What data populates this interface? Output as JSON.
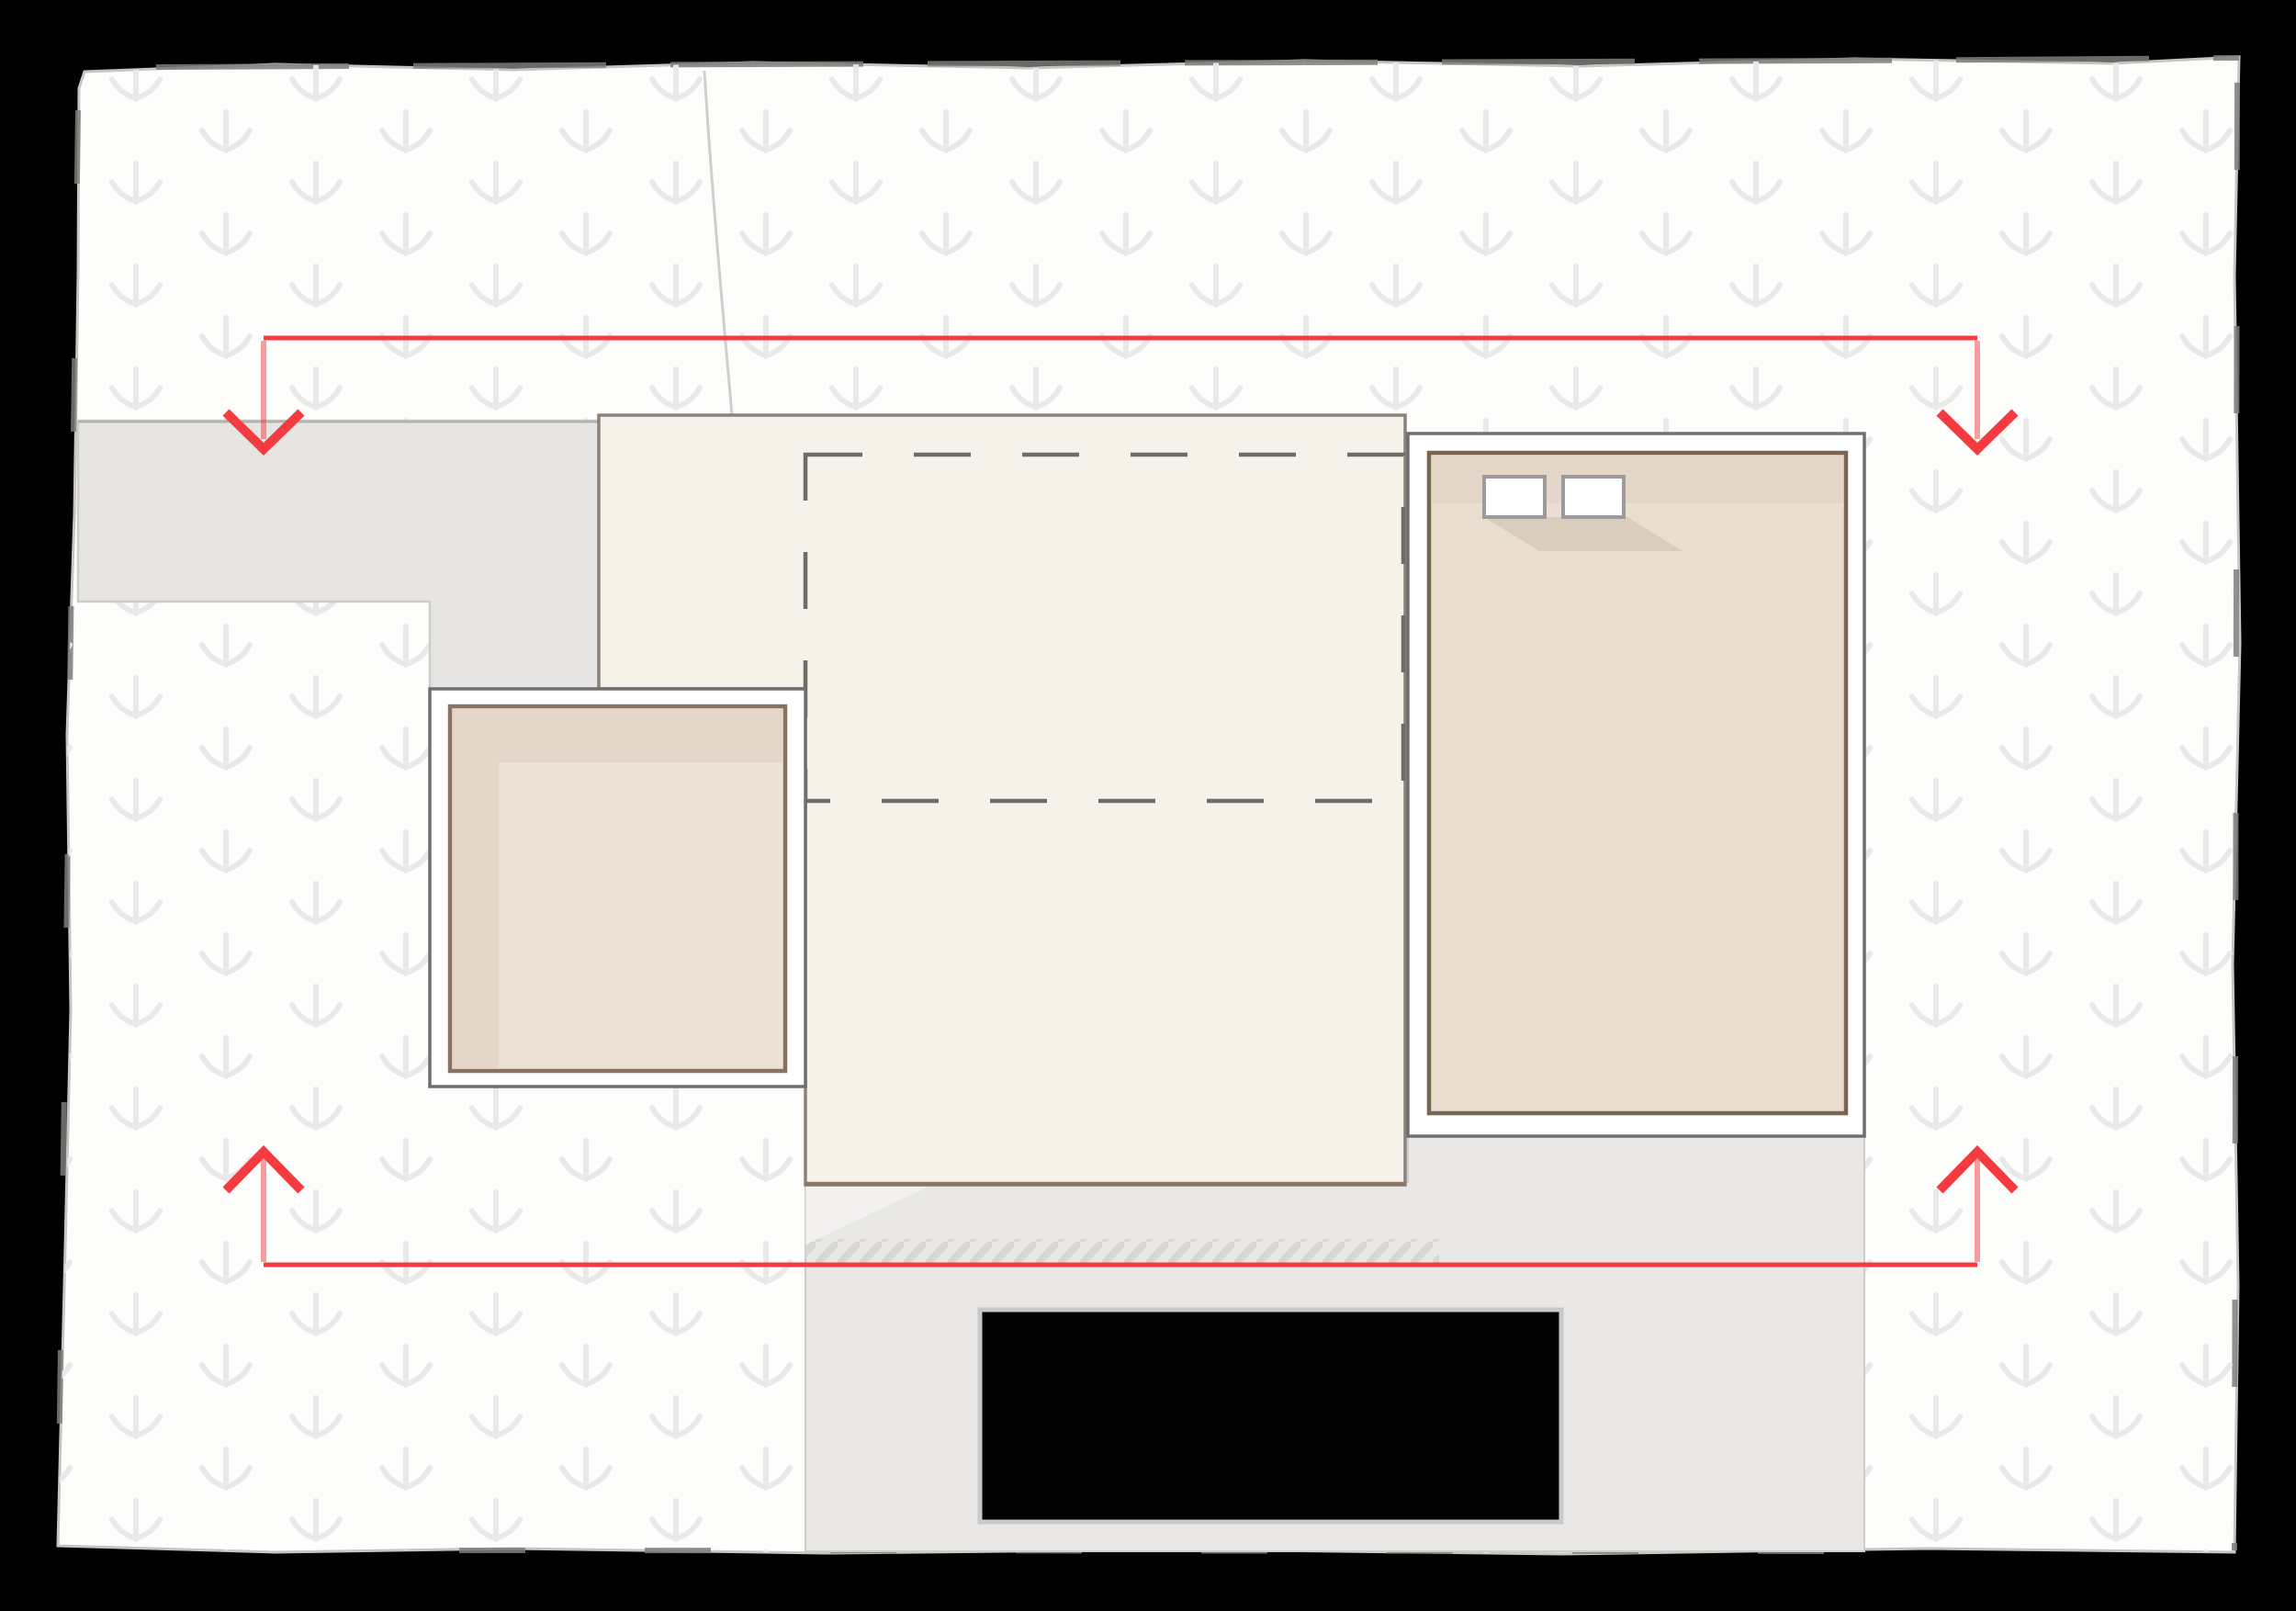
{
  "document": {
    "kind": "architectural-site-plan-sketch",
    "visible_text": [],
    "description": "Hand-drawn style site plan: white parcel sheet on black background, faint planting-arrow pattern, gray road and driveway, cream main building with dashed roof outline, two tan accessory volumes in white frames, two roof skylights, red dimension arrows across top and bottom, hatched crossing strip on driveway, solid black vehicle rectangle."
  },
  "legend": {
    "pattern_symbol": "down-arrow-planting-icon",
    "dimension_marks": "red arrows pointing into parcel at four corners",
    "boundary_style": "sketchy gray outline with intermittent darker dashes"
  },
  "counts": {
    "buildings": 3,
    "skylights": 2,
    "red_arrows": 4,
    "vehicles_or_labels": 1
  },
  "colors": {
    "accent_red": "#f43b3f",
    "paper": "#fdfdfc",
    "paper_edge": "#c6c5c2",
    "paper_edge_dark": "#7d7c7a",
    "crease": "#cfcfcd",
    "pattern_glyph": "#e9e9e9",
    "road": "#e6e5e3",
    "driveway": "#e9e8e6",
    "road_edge_dark": "#b3b2af",
    "road_edge_light": "#cecdca",
    "building_fill": "#f6f1e9",
    "building_border": "#8b8278",
    "building_bottom_border": "#877763",
    "frame_fill": "#ffffff",
    "frame_border": "#6f6f6f",
    "tan_left": "#ece2d6",
    "tan_right": "#e9decf",
    "tan_dark_strip": "#e4d7c9",
    "tan_shadow": "#c9bcae",
    "tan_border_left": "#8a7260",
    "tan_border_right": "#7b6452",
    "skylight_fill": "#ffffff",
    "skylight_border": "#9b9b9b",
    "dash_line": "#6f6b66",
    "hatch_stroke": "#d8d7d4",
    "car_fill": "#020202",
    "car_border": "#c9c9c8",
    "background": "#000000"
  }
}
